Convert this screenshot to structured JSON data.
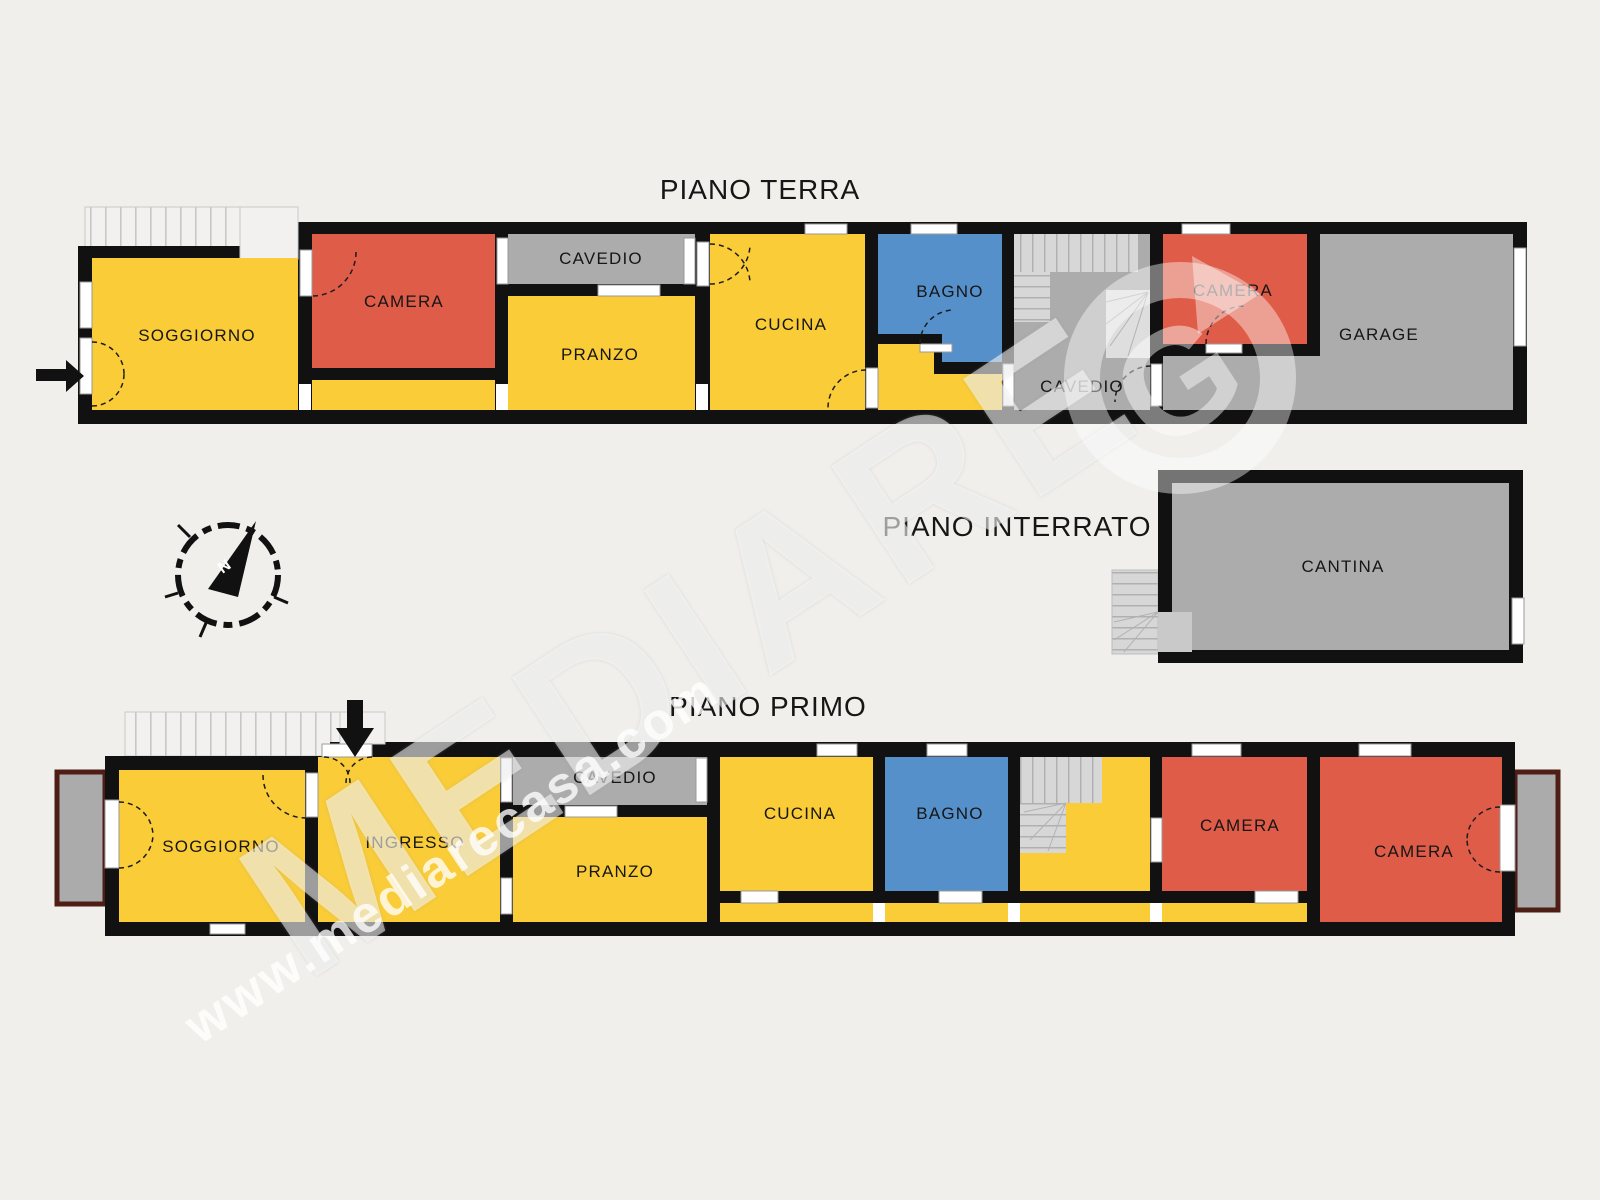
{
  "page": {
    "background": "#f0efec"
  },
  "floors": {
    "piano_terra": {
      "title": "PIANO TERRA",
      "rooms": {
        "soggiorno": "SOGGIORNO",
        "camera_1": "CAMERA",
        "cavedio_1": "CAVEDIO",
        "pranzo": "PRANZO",
        "cucina": "CUCINA",
        "bagno": "BAGNO",
        "cavedio_2": "CAVEDIO",
        "camera_2": "CAMERA",
        "garage": "GARAGE"
      }
    },
    "piano_interrato": {
      "title": "PIANO INTERRATO",
      "rooms": {
        "cantina": "CANTINA"
      }
    },
    "piano_primo": {
      "title": "PIANO PRIMO",
      "rooms": {
        "soggiorno": "SOGGIORNO",
        "ingresso": "INGRESSO",
        "cavedio": "CAVEDIO",
        "pranzo": "PRANZO",
        "cucina": "CUCINA",
        "bagno": "BAGNO",
        "camera_1": "CAMERA",
        "camera_2": "CAMERA"
      }
    }
  },
  "watermark": {
    "brand": "MEDIARE",
    "website": "www.mediarecasa.com",
    "logo_glyph": "G"
  },
  "compass": {
    "north": "N"
  },
  "colors": {
    "page_bg": "#f0efec",
    "wall": "#111111",
    "room_yellow": "#f9cc38",
    "room_red": "#de5c48",
    "room_blue": "#5590cb",
    "room_gray": "#acacac",
    "balcony_border": "#4d1d16"
  }
}
